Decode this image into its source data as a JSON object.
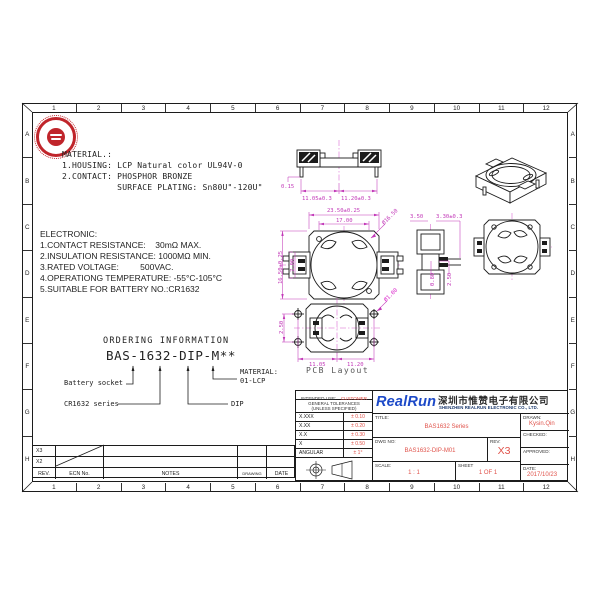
{
  "sheet": {
    "columns": [
      "1",
      "2",
      "3",
      "4",
      "5",
      "6",
      "7",
      "8",
      "9",
      "10",
      "11",
      "12"
    ],
    "rows": [
      "A",
      "B",
      "C",
      "D",
      "E",
      "F",
      "G",
      "H"
    ]
  },
  "material": {
    "title": "MATERIAL.:",
    "lines": [
      "1.HOUSING: LCP Natural color UL94V-0",
      "2.CONTACT: PHOSPHOR BRONZE",
      "           SURFACE PLATING: Sn80U\"-120U\""
    ]
  },
  "electronic": {
    "title": "ELECTRONIC:",
    "lines": [
      "1.CONTACT RESISTANCE:    30mΩ MAX.",
      "2.INSULATION RESISTANCE: 1000MΩ MIN.",
      "3.RATED VOLTAGE:         500VAC.",
      "4.OPERATIONG TEMPERATURE: -55°C-105°C",
      "5.SUITABLE FOR BATTERY NO.:CR1632"
    ]
  },
  "ordering": {
    "title": "ORDERING INFORMATION",
    "part_number": "BAS-1632-DIP-M**",
    "battery_label": "Battery socket",
    "series_label": "CR1632 series",
    "dip_label": "DIP",
    "material_label": "MATERIAL:",
    "material_value": "01-LCP"
  },
  "views": {
    "front": {
      "thickness": "0.15",
      "left": "11.05±0.3",
      "right": "11.20±0.3"
    },
    "top": {
      "width": "23.50±0.25",
      "inner_width": "17.00",
      "diameter": "Ø16.50",
      "height": "16.50±0.25",
      "inner_height": "7.00"
    },
    "side": {
      "a": "3.50",
      "b": "3.30±0.3",
      "c": "0.80",
      "d": "2.50"
    },
    "pcb": {
      "pitch": "2.50",
      "left": "11.05",
      "right": "11.20",
      "hole": "Ø1.00",
      "caption": "PCB Layout"
    }
  },
  "revisions": {
    "col_rev": "REV.",
    "col_ecn": "ECN No.",
    "col_notes": "NOTES",
    "col_drawing": "DRAWING",
    "col_date": "DATE",
    "row1_rev": "X3",
    "row2_rev": "X2"
  },
  "title_block": {
    "intended_use_label": "INTENDED USE:",
    "intended_use_value": "CUSTOMER",
    "tol_title1": "GENERAL TOLERANCES",
    "tol_title2": "(UNLESS SPECIFIED)",
    "tolerances": [
      {
        "label": "X.XXX",
        "value": "± 0.10"
      },
      {
        "label": "X.XX",
        "value": "± 0.20"
      },
      {
        "label": "X.X",
        "value": "± 0.30"
      },
      {
        "label": "X",
        "value": "± 0.50"
      },
      {
        "label": "ANGULAR",
        "value": "± 1°"
      }
    ],
    "brand": "RealRun",
    "company_cn": "深圳市惟赞电子有限公司",
    "company_en": "SHENZHEN REALRUN ELECTRONIC CO., LTD.",
    "title_label": "TITLE:",
    "title_value": "BAS1632 Series",
    "dwg_label": "DWG NO:",
    "dwg_value": "BAS1632-DIP-M01",
    "rev_label": "REV:",
    "rev_value": "X3",
    "scale_label": "SCALE:",
    "scale_value": "1 : 1",
    "sheet_label": "SHEET",
    "sheet_value": "1 OF 1",
    "drawn_label": "DRAWN:",
    "drawn_value": "Kysin.Qin",
    "checked_label": "CHECKED:",
    "approved_label": "APPROVED:",
    "date_label": "DATE:",
    "date_value": "2017/10/23"
  }
}
